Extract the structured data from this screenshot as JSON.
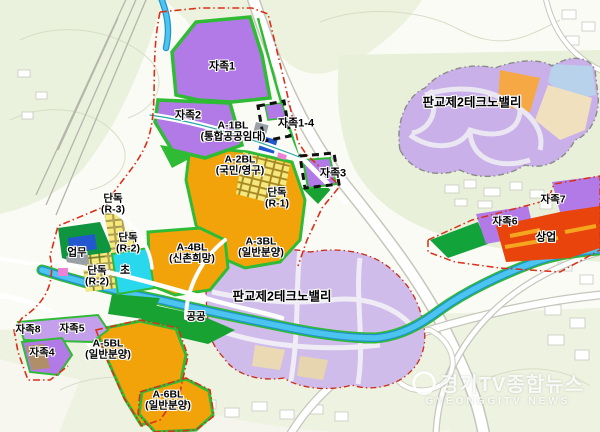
{
  "map": {
    "labels": [
      {
        "id": "jajok1",
        "text": [
          "자족1"
        ],
        "x": 222,
        "y": 67,
        "size": 11
      },
      {
        "id": "jajok2",
        "text": [
          "자족2"
        ],
        "x": 188,
        "y": 116,
        "size": 11
      },
      {
        "id": "a1bl",
        "text": [
          "A-1BL",
          "(통합공공임대)"
        ],
        "x": 233,
        "y": 131,
        "size": 10.5
      },
      {
        "id": "jajok1-4",
        "text": [
          "자족1-4"
        ],
        "x": 296,
        "y": 124,
        "size": 11
      },
      {
        "id": "a2bl",
        "text": [
          "A-2BL",
          "(국민/영구)"
        ],
        "x": 240,
        "y": 165,
        "size": 10.5
      },
      {
        "id": "jajok3",
        "text": [
          "자족3"
        ],
        "x": 333,
        "y": 174,
        "size": 11
      },
      {
        "id": "dandok-r1",
        "text": [
          "단독",
          "(R-1)"
        ],
        "x": 277,
        "y": 198,
        "size": 10.5
      },
      {
        "id": "dandok-r3",
        "text": [
          "단독",
          "(R-3)"
        ],
        "x": 113,
        "y": 204,
        "size": 10.5
      },
      {
        "id": "dandok-r2a",
        "text": [
          "단독",
          "(R-2)"
        ],
        "x": 128,
        "y": 243,
        "size": 10.5
      },
      {
        "id": "eopmu",
        "text": [
          "업무"
        ],
        "x": 77,
        "y": 253,
        "size": 10.5
      },
      {
        "id": "dandok-r2b",
        "text": [
          "단독",
          "(R-2)"
        ],
        "x": 97,
        "y": 276,
        "size": 10.5
      },
      {
        "id": "cho",
        "text": [
          "초"
        ],
        "x": 125,
        "y": 271,
        "size": 11
      },
      {
        "id": "a4bl",
        "text": [
          "A-4BL",
          "(신촌희망)"
        ],
        "x": 192,
        "y": 253,
        "size": 10.5
      },
      {
        "id": "a3bl",
        "text": [
          "A-3BL",
          "(일반분양)"
        ],
        "x": 261,
        "y": 247,
        "size": 10.5
      },
      {
        "id": "technovalley-top",
        "text": [
          "판교제2테크노밸리"
        ],
        "x": 472,
        "y": 103,
        "size": 12.5
      },
      {
        "id": "technovalley-bottom",
        "text": [
          "판교제2테크노밸리"
        ],
        "x": 282,
        "y": 297,
        "size": 12.5
      },
      {
        "id": "gonggong",
        "text": [
          "공공"
        ],
        "x": 196,
        "y": 317,
        "size": 10.5
      },
      {
        "id": "jajok8",
        "text": [
          "자족8"
        ],
        "x": 28,
        "y": 330,
        "size": 10.5
      },
      {
        "id": "jajok5",
        "text": [
          "자족5"
        ],
        "x": 72,
        "y": 329,
        "size": 10.5
      },
      {
        "id": "jajok4",
        "text": [
          "자족4"
        ],
        "x": 42,
        "y": 353,
        "size": 10.5
      },
      {
        "id": "a5bl",
        "text": [
          "A-5BL",
          "(일반분양)"
        ],
        "x": 108,
        "y": 349,
        "size": 10.5
      },
      {
        "id": "a6bl",
        "text": [
          "A-6BL",
          "(일반분양)"
        ],
        "x": 168,
        "y": 400,
        "size": 10.5
      },
      {
        "id": "jajok7",
        "text": [
          "자족7"
        ],
        "x": 553,
        "y": 200,
        "size": 10.5
      },
      {
        "id": "jajok6",
        "text": [
          "자족6"
        ],
        "x": 505,
        "y": 222,
        "size": 10.5
      },
      {
        "id": "sangeop",
        "text": [
          "상업"
        ],
        "x": 546,
        "y": 238,
        "size": 11
      }
    ],
    "legend_colors": {
      "self_sufficiency_purple": "#b27ae6",
      "residential_orange": "#f2a30a",
      "commercial_red": "#e8440c",
      "school_cyan": "#29d8ec",
      "park_green": "#2fbb35",
      "business_blue": "#2257d0",
      "technovalley_lavender": "#c9b0e8",
      "water_blue": "#4cc4f0",
      "boundary_red": "#d93018"
    }
  },
  "watermark": {
    "line1": "경기TV종합뉴스",
    "line2": "GYEONGGITV NEWS"
  }
}
